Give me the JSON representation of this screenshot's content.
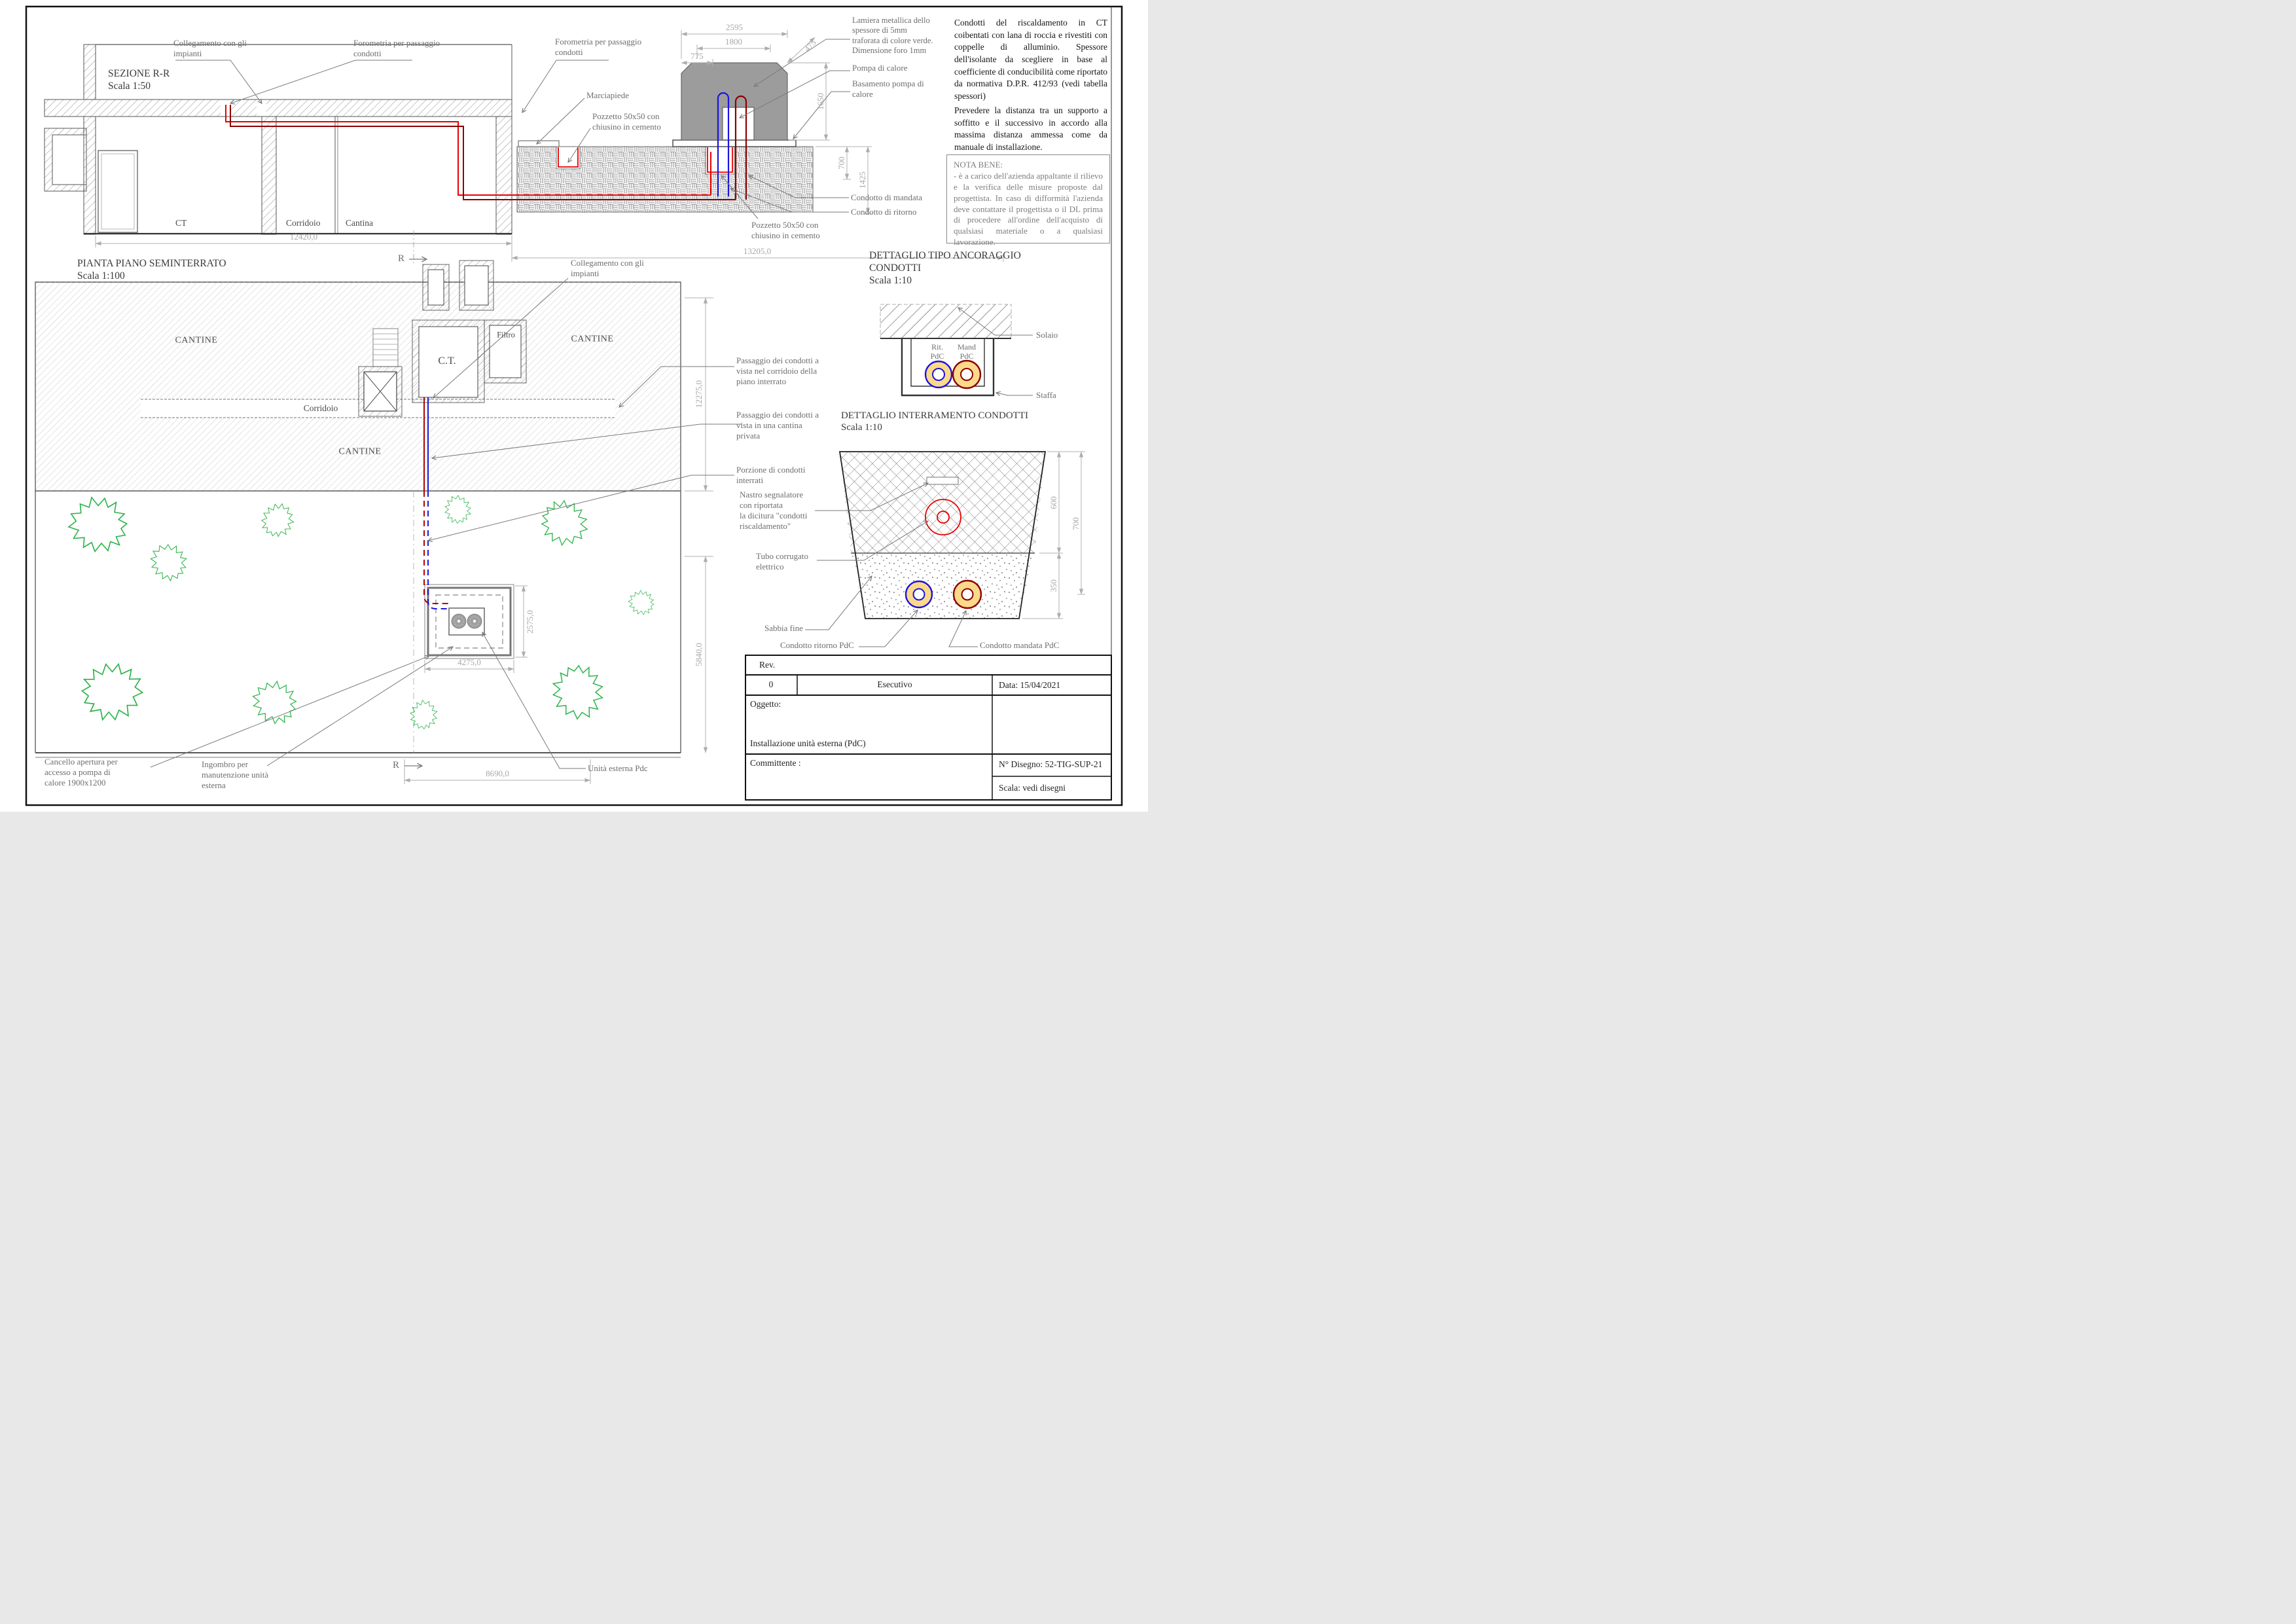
{
  "section": {
    "title": "SEZIONE R-R\nScala 1:50",
    "rooms": {
      "ct": "CT",
      "corridoio": "Corridoio",
      "cantina": "Cantina"
    },
    "callouts": {
      "collegamento": "Collegamento con gli\nimpianti",
      "forometria1": "Forometria per passaggio\ncondotti",
      "forometria2": "Forometria per passaggio\ncondotti",
      "marciapiede": "Marciapiede",
      "pozzetto1": "Pozzetto 50x50 con\nchiusino in cemento",
      "lamiera": "Lamiera metallica dello\nspessore di 5mm\ntraforata di colore verde.\nDimensione foro 1mm",
      "pompa": "Pompa di calore",
      "basamento": "Basamento pompa di\ncalore",
      "mandata": "Condotto di mandata",
      "ritorno": "Condotto di ritorno",
      "pozzetto2": "Pozzetto 50x50 con\nchiusino in cemento"
    },
    "dims": {
      "d2595": "2595",
      "d1800": "1800",
      "d775": "775",
      "d475": "475",
      "d1650": "1650",
      "d700": "700",
      "d1425": "1425",
      "d12420": "12420,0",
      "d13205": "13205,0"
    },
    "marker_r": "R"
  },
  "plan": {
    "title": "PIANTA PIANO SEMINTERRATO\nScala 1:100",
    "rooms": {
      "cantine_left": "CANTINE",
      "cantine_right": "CANTINE",
      "cantine_lower": "CANTINE",
      "ct": "C.T.",
      "filtro": "Filtro",
      "corridoio": "Corridoio"
    },
    "callouts": {
      "collegamento": "Collegamento con gli\nimpianti",
      "passaggio_corridoio": "Passaggio dei condotti a\nvista nel corridoio della\npiano interrato",
      "passaggio_cantina": "Passaggio dei condotti a\nvista in una cantina\nprivata",
      "porzione": "Porzione di condotti\ninterrati",
      "cancello": "Cancello apertura per\naccesso a pompa di\ncalore 1900x1200",
      "ingombro": "Ingombro per\nmanutenzione unità\nesterna",
      "unita": "Unità esterna Pdc"
    },
    "dims": {
      "d12275": "12275,0",
      "d5840": "5840,0",
      "d4275": "4275,0",
      "d2575": "2575,0",
      "d8690": "8690,0"
    },
    "marker_r_top": "R",
    "marker_r_bottom": "R"
  },
  "detail_anchor": {
    "title": "DETTAGLIO TIPO ANCORAGGIO\nCONDOTTI\nScala 1:10",
    "labels": {
      "rit": "Rit.\nPdC",
      "mand": "Mand\nPdC",
      "solaio": "Solaio",
      "staffa": "Staffa"
    }
  },
  "detail_trench": {
    "title": "DETTAGLIO INTERRAMENTO CONDOTTI\nScala 1:10",
    "labels": {
      "nastro": "Nastro segnalatore\ncon riportata\nla dicitura \"condotti\nriscaldamento\"",
      "tubo": "Tubo corrugato\nelettrico",
      "sabbia": "Sabbia fine",
      "ritorno": "Condotto ritorno PdC",
      "mandata": "Condotto mandata PdC"
    },
    "dims": {
      "d600": "600",
      "d700": "700",
      "d350": "350"
    }
  },
  "notes": {
    "spec1": "Condotti del riscaldamento in CT coibentati con lana di roccia e rivestiti con coppelle di alluminio. Spessore dell'isolante da scegliere in base al coefficiente di conducibilità come riportato da normativa D.P.R. 412/93 (vedi tabella spessori)",
    "spec2": "Prevedere la distanza tra un supporto a soffitto e il successivo in accordo alla massima distanza ammessa come da manuale di installazione.",
    "nota_title": "NOTA BENE:",
    "nota_body": "- è a carico dell'azienda appaltante il rilievo e la verifica delle misure proposte dal progettista. In caso di difformità l'azienda deve contattare il progettista o il DL prima di procedere all'ordine dell'acquisto di qualsiasi materiale o a qualsiasi lavorazione."
  },
  "titleblock": {
    "rev_label": "Rev.",
    "rev_value": "0",
    "status": "Esecutivo",
    "date": "Data: 15/04/2021",
    "oggetto_label": "Oggetto:",
    "oggetto_value": "Installazione unità esterna (PdC)",
    "committente_label": "Committente :",
    "drawing_no": "N° Disegno: 52-TIG-SUP-21",
    "scale": "Scala: vedi disegni"
  },
  "colors": {
    "supply": "#8b0000",
    "return_pipe": "#1d14dd",
    "hot": "#e80000",
    "insulation": "#fbd98b",
    "tree": "#2db34a",
    "pump_fill": "#9c9c9c"
  }
}
